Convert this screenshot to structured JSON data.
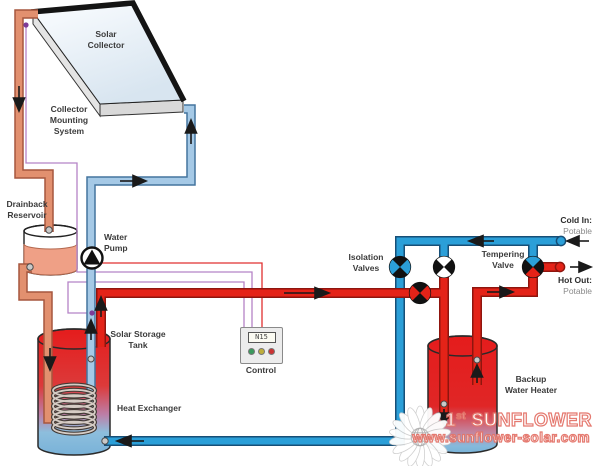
{
  "labels": {
    "solar_collector": "Solar\nCollector",
    "collector_mounting": "Collector\nMounting\nSystem",
    "drainback_reservoir": "Drainback\nReservoir",
    "water_pump": "Water\nPump",
    "solar_storage_tank": "Solar Storage\nTank",
    "heat_exchanger": "Heat Exchanger",
    "control": "Control",
    "isolation_valves": "Isolation\nValves",
    "tempering_valve": "Tempering\nValve",
    "cold_in": "Cold In:",
    "cold_in_sub": "Potable",
    "hot_out": "Hot Out:",
    "hot_out_sub": "Potable",
    "backup_water_heater": "Backup\nWater Heater"
  },
  "control": {
    "display": "N15",
    "leds": [
      "green",
      "yellow",
      "red"
    ]
  },
  "watermark": {
    "brand_number": "1",
    "brand_ordinal": "st",
    "brand_word": "SUNFLOWER",
    "url": "www.sunflower-solar.com"
  },
  "colors": {
    "collector_supply_pipe": "#E2906F",
    "collector_supply_outline": "#A6573E",
    "collector_return_pipe": "#A5C9E6",
    "collector_return_outline": "#44749E",
    "potable_cold": "#2B9FD8",
    "potable_cold_outline": "#174F77",
    "potable_hot": "#E42318",
    "potable_hot_outline": "#8F150E",
    "sensor_wire": "#B583C6",
    "pump_wire": "#E03030",
    "tank_hot": "#E51C1C",
    "tank_cold": "#79B2D8",
    "led_green": "#3A9A5C",
    "led_yellow": "#BFAE3A",
    "led_red": "#CC3333",
    "watermark_stroke": "#E4756B"
  }
}
